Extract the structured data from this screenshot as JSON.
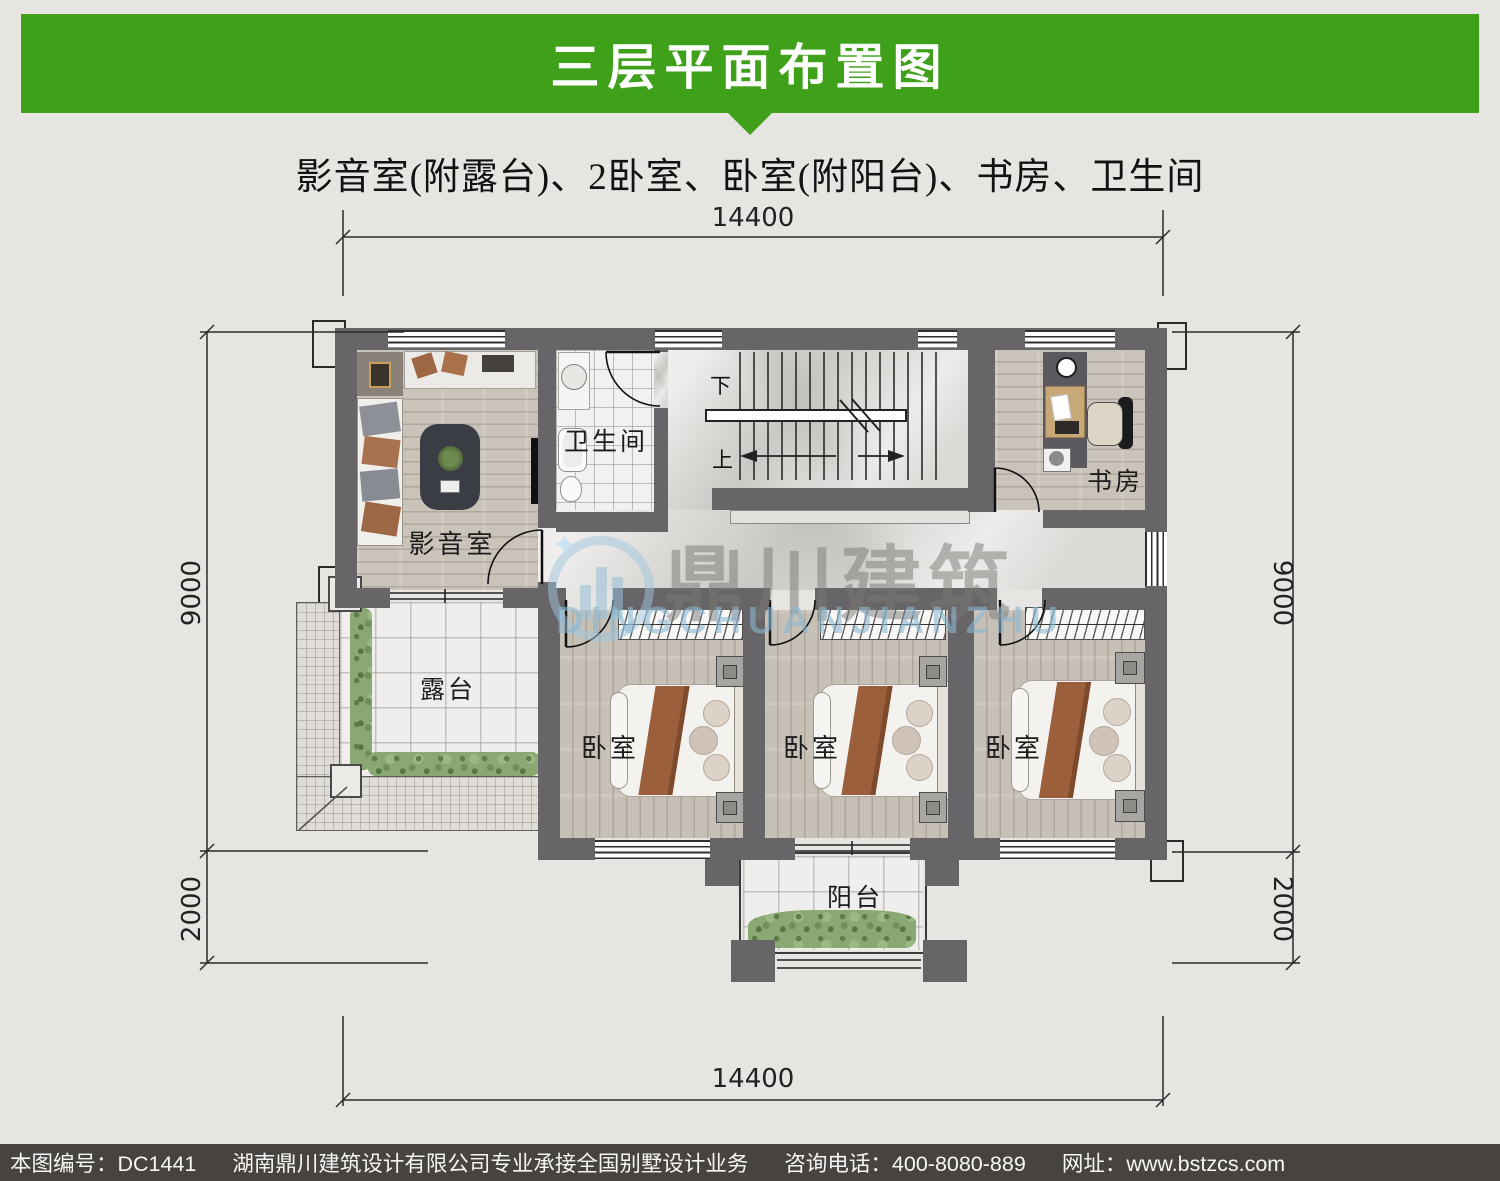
{
  "header": {
    "title": "三层平面布置图"
  },
  "subtitle": "影音室(附露台)、2卧室、卧室(附阳台)、书房、卫生间",
  "plan": {
    "rooms": {
      "media": "影音室",
      "bath": "卫生间",
      "study": "书房",
      "terrace": "露台",
      "bedroom1": "卧室",
      "bedroom2": "卧室",
      "bedroom3": "卧室",
      "balcony": "阳台"
    },
    "stairs": {
      "down": "下",
      "up": "上"
    },
    "dims": {
      "top": "14400",
      "bottom": "14400",
      "left_upper": "9000",
      "left_lower": "2000",
      "right_upper": "9000",
      "right_lower": "2000"
    }
  },
  "watermark": {
    "cn": "鼎川建筑",
    "en": "DINGCHUANJIANZHU"
  },
  "footer": {
    "drawing_no": "本图编号：DC1441",
    "company": "湖南鼎川建筑设计有限公司专业承接全国别墅设计业务",
    "phone": "咨询电话：400-8080-889",
    "website": "网址：www.bstzcs.com"
  }
}
